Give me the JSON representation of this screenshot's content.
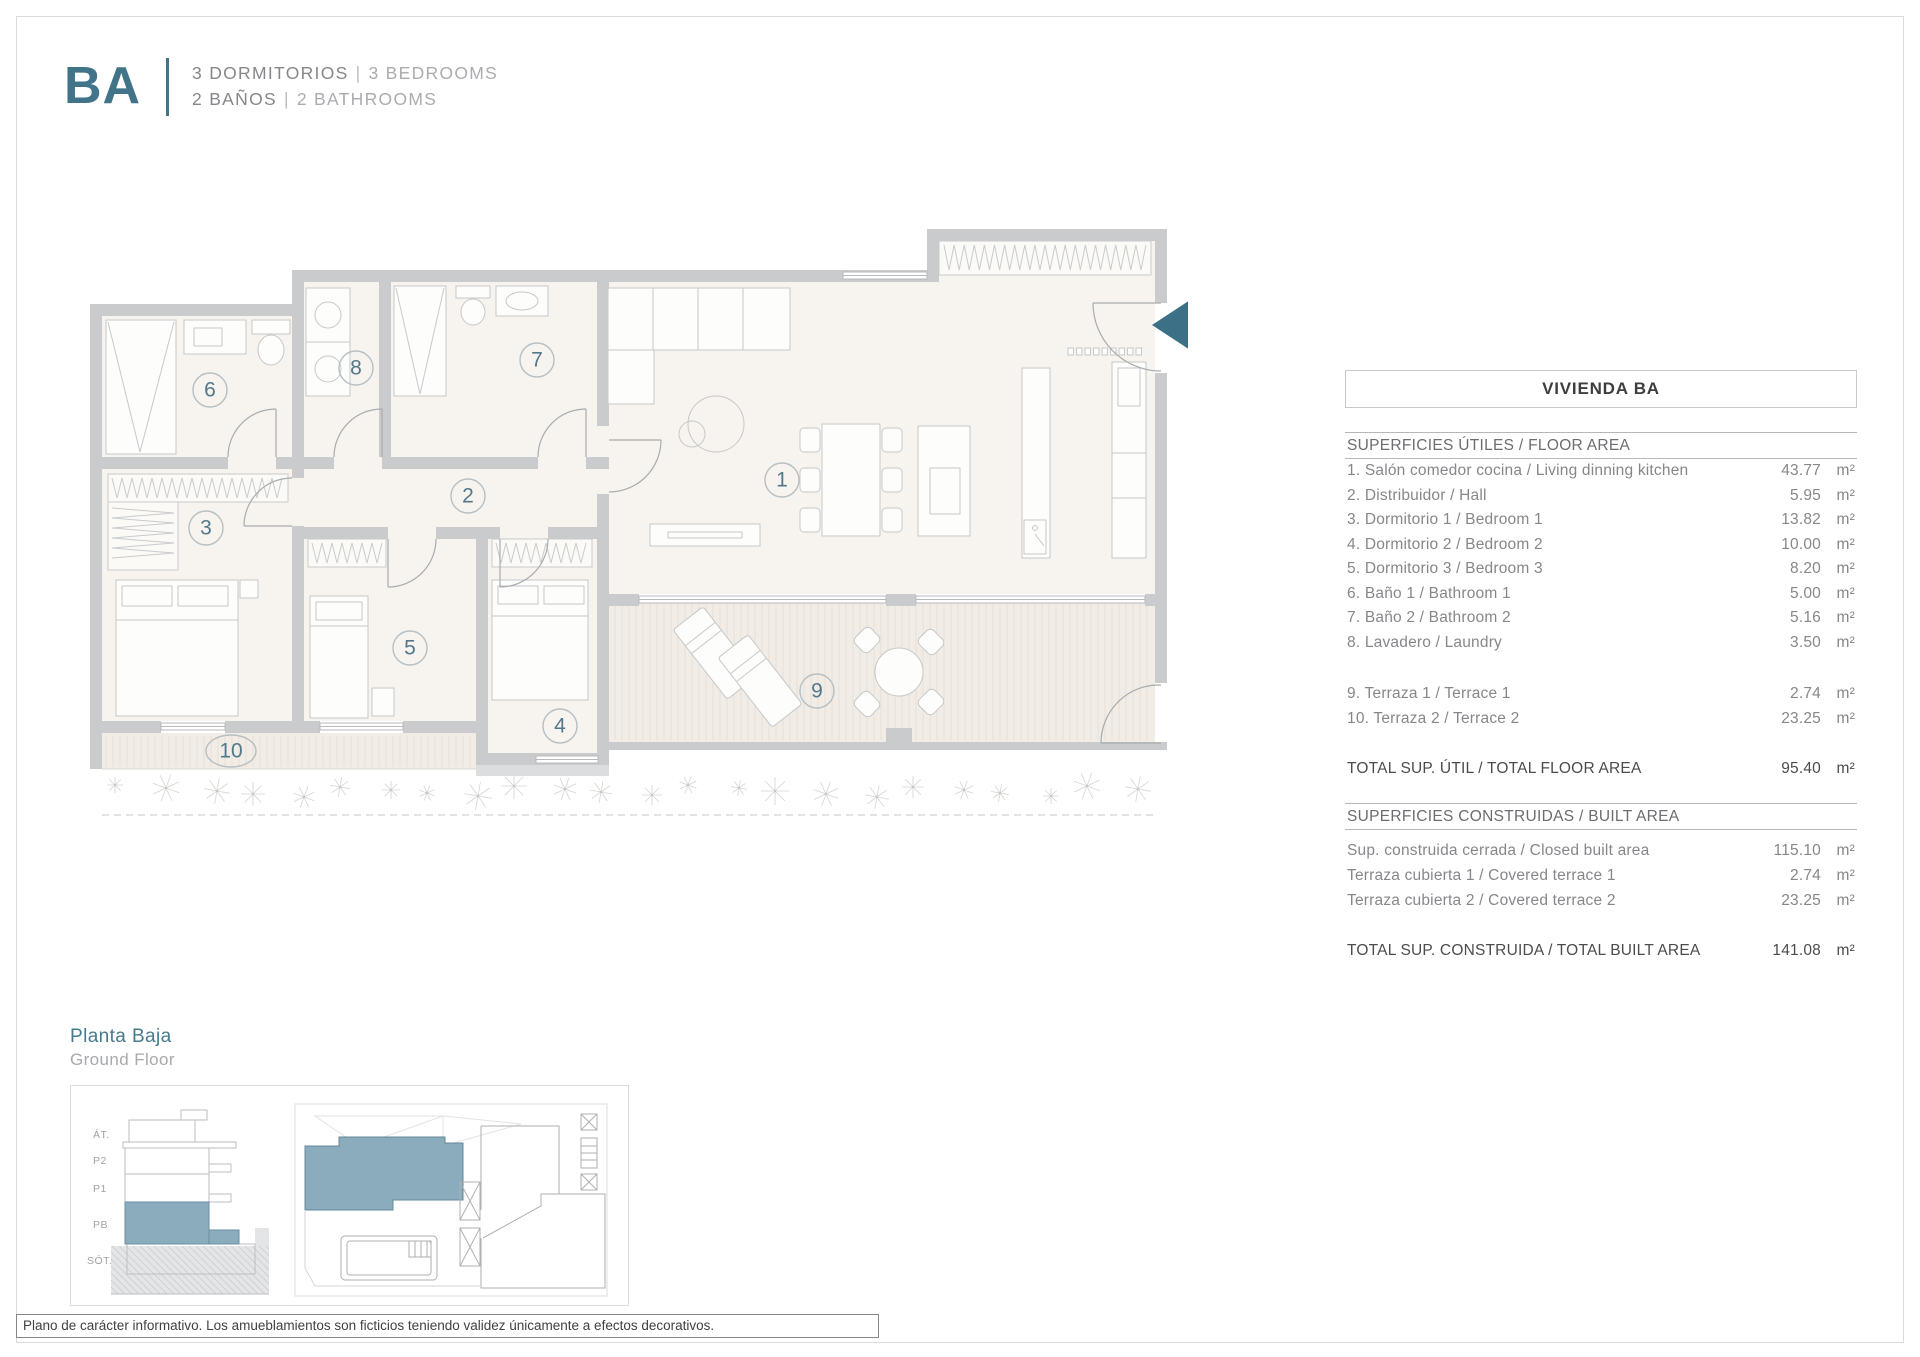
{
  "header": {
    "logo": "BA",
    "bedrooms_es": "3 DORMITORIOS",
    "bedrooms_en": "3 BEDROOMS",
    "bathrooms_es": "2 BAÑOS",
    "bathrooms_en": "2 BATHROOMS",
    "separator": "|"
  },
  "floor_plan": {
    "rooms": [
      "1",
      "2",
      "3",
      "4",
      "5",
      "6",
      "7",
      "8",
      "9",
      "10"
    ]
  },
  "area_table": {
    "title": "VIVIENDA BA",
    "floor_area": {
      "heading": "SUPERFICIES ÚTILES / FLOOR AREA",
      "rows": [
        {
          "label": "1. Salón comedor cocina / Living dinning kitchen",
          "value": "43.77",
          "unit": "m²"
        },
        {
          "label": "2. Distribuidor / Hall",
          "value": "5.95",
          "unit": "m²"
        },
        {
          "label": "3. Dormitorio 1 / Bedroom 1",
          "value": "13.82",
          "unit": "m²"
        },
        {
          "label": "4. Dormitorio 2 / Bedroom 2",
          "value": "10.00",
          "unit": "m²"
        },
        {
          "label": "5. Dormitorio 3 / Bedroom 3",
          "value": "8.20",
          "unit": "m²"
        },
        {
          "label": "6. Baño 1 / Bathroom 1",
          "value": "5.00",
          "unit": "m²"
        },
        {
          "label": "7. Baño 2 / Bathroom 2",
          "value": "5.16",
          "unit": "m²"
        },
        {
          "label": "8. Lavadero / Laundry",
          "value": "3.50",
          "unit": "m²"
        }
      ],
      "terrace_rows": [
        {
          "label": "9. Terraza 1 / Terrace 1",
          "value": "2.74",
          "unit": "m²"
        },
        {
          "label": "10. Terraza 2 /  Terrace 2",
          "value": "23.25",
          "unit": "m²"
        }
      ],
      "total": {
        "label": "TOTAL SUP. ÚTIL / TOTAL FLOOR AREA",
        "value": "95.40",
        "unit": "m²"
      }
    },
    "built_area": {
      "heading": "SUPERFICIES CONSTRUIDAS / BUILT AREA",
      "rows": [
        {
          "label": "Sup. construida cerrada / Closed built area",
          "value": "115.10",
          "unit": "m²"
        },
        {
          "label": "Terraza cubierta 1 / Covered terrace 1",
          "value": "2.74",
          "unit": "m²"
        },
        {
          "label": "Terraza cubierta 2 / Covered terrace 2",
          "value": "23.25",
          "unit": "m²"
        }
      ],
      "total": {
        "label": "TOTAL SUP. CONSTRUIDA /  TOTAL BUILT AREA",
        "value": "141.08",
        "unit": "m²"
      }
    }
  },
  "floor_key": {
    "title_es": "Planta Baja",
    "title_en": "Ground Floor",
    "levels": [
      "ÁT.",
      "P2",
      "P1",
      "PB",
      "SÓT."
    ]
  },
  "disclaimer": "Plano de carácter informativo. Los amueblamientos son ficticios teniendo validez únicamente a efectos decorativos.",
  "colors": {
    "accent": "#417489",
    "accent_light": "#8aacbc",
    "entrance_arrow": "#3c7086"
  }
}
